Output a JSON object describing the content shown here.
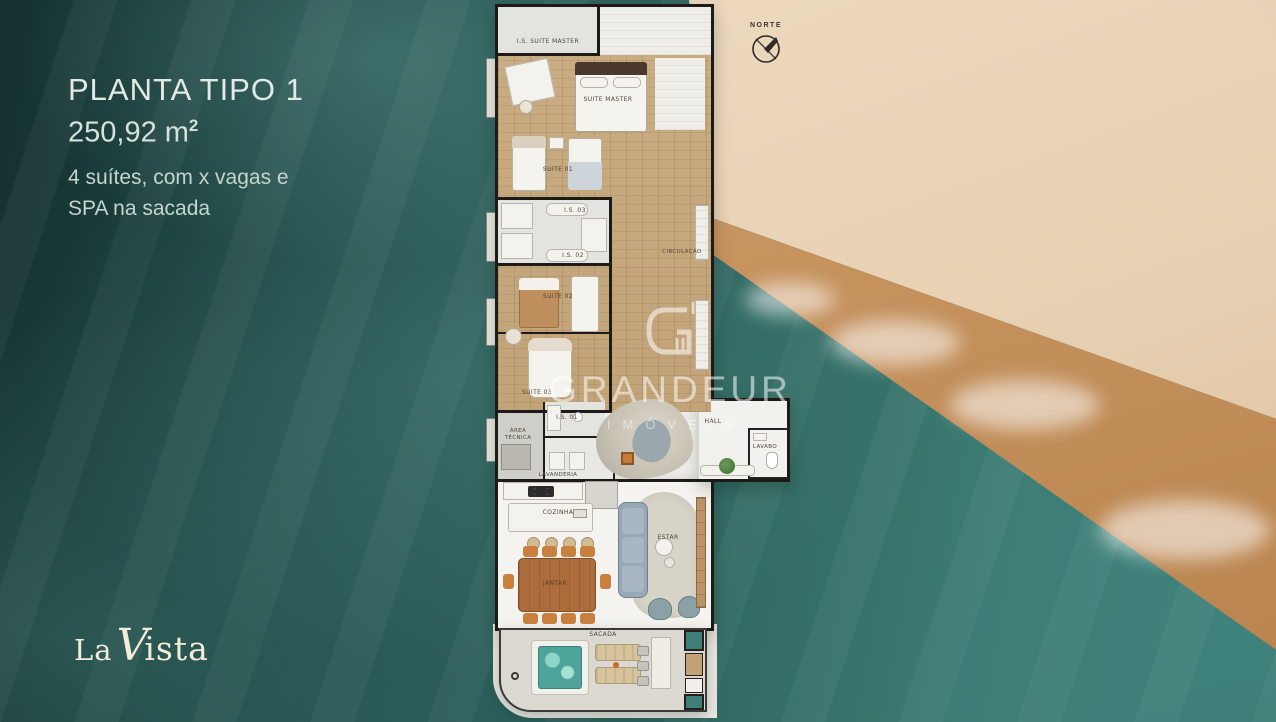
{
  "header": {
    "title": "PLANTA TIPO 1",
    "area": "250,92 m",
    "area_sup": "2",
    "desc_line1": "4 suítes, com x vagas e",
    "desc_line2": "SPA na sacada"
  },
  "compass": {
    "label": "NORTE"
  },
  "watermark": {
    "brand": "GRANDEUR",
    "subtitle": "IMÓVEIS"
  },
  "logo": {
    "la": "La",
    "v": "V",
    "ista": "ista"
  },
  "plan": {
    "rooms": [
      {
        "label": "I.S. SUITE MASTER"
      },
      {
        "label": "SUITE MASTER"
      },
      {
        "label": "SUITE 01"
      },
      {
        "label": "I.S. 03"
      },
      {
        "label": "I.S. 02"
      },
      {
        "label": "SUITE 02"
      },
      {
        "label": "CIRCULAÇÃO"
      },
      {
        "label": "SUITE 03"
      },
      {
        "label": "I.S. 01"
      },
      {
        "label": "ÁREA TÉCNICA"
      },
      {
        "label": "LAVANDERIA"
      },
      {
        "label": "HALL"
      },
      {
        "label": "LAVABO"
      },
      {
        "label": "COZINHA"
      },
      {
        "label": "JANTAR"
      },
      {
        "label": "ESTAR"
      },
      {
        "label": "SACADA"
      }
    ]
  },
  "colors": {
    "ocean_teal": "#2a5c58",
    "sand": "#e7d0b2",
    "wet_sand": "#c09058",
    "wood_floor": "#c5a77d",
    "wall": "#1d1b18",
    "spa_water": "#4ea39a",
    "dining_wood": "#ad6c3c",
    "sofa_blue": "#99a8b6",
    "title_text": "#e2eae5",
    "logo_cream": "#f2ecd9"
  }
}
